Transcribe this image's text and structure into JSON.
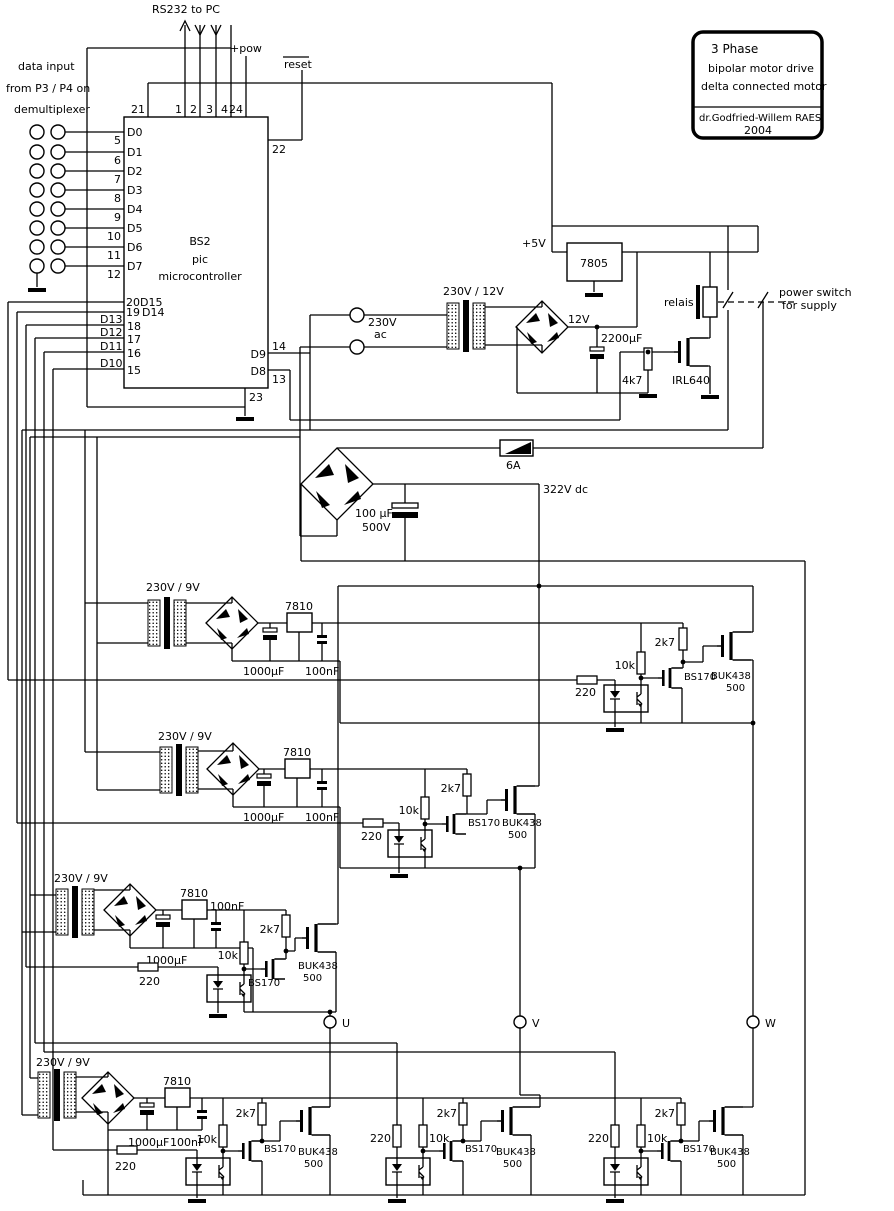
{
  "header": {
    "rs232": "RS232 to PC",
    "pow": "+pow",
    "reset": "reset"
  },
  "data_input": {
    "l1": "data input",
    "l2": "from P3 / P4 on",
    "l3": "demultiplexer"
  },
  "title_block": {
    "l1": "3 Phase",
    "l2": "bipolar  motor drive",
    "l3": "delta connected motor",
    "author": "dr.Godfried-Willem RAES",
    "year": "2004"
  },
  "mcu": {
    "l1": "BS2",
    "l2": "pic",
    "l3": "microcontroller",
    "top_pins": [
      "21",
      "1",
      "2",
      "3",
      "4",
      "24"
    ],
    "pin22": "22",
    "pin23": "23",
    "data_pins": [
      {
        "pin": "5",
        "name": "D0"
      },
      {
        "pin": "6",
        "name": "D1"
      },
      {
        "pin": "7",
        "name": "D2"
      },
      {
        "pin": "8",
        "name": "D3"
      },
      {
        "pin": "9",
        "name": "D4"
      },
      {
        "pin": "10",
        "name": "D5"
      },
      {
        "pin": "11",
        "name": "D6"
      },
      {
        "pin": "12",
        "name": "D7"
      }
    ],
    "bus_pins": [
      {
        "pin": "20",
        "name": "D15"
      },
      {
        "pin": "19",
        "name": "D14"
      },
      {
        "pin": "18",
        "name": "D13"
      },
      {
        "pin": "17",
        "name": "D12"
      },
      {
        "pin": "16",
        "name": "D11"
      },
      {
        "pin": "15",
        "name": "D10"
      }
    ],
    "right_pins": [
      {
        "pin": "14",
        "name": "D9"
      },
      {
        "pin": "13",
        "name": "D8"
      }
    ]
  },
  "psu": {
    "v5": "+5V",
    "reg": "7805",
    "xfmr": "230V / 12V",
    "mains_v": "230V",
    "mains_ac": "ac",
    "v12": "12V",
    "cap": "2200µF",
    "relay": "relais",
    "switch_l1": "power switch",
    "switch_l2": "for supply",
    "r_gate": "4k7",
    "fet": "IRL640"
  },
  "dc_bus": {
    "fuse": "6A",
    "volts": "322V dc",
    "cap_v": "100 µF",
    "cap_r": "500V"
  },
  "parts": {
    "xfmr": "230V / 9V",
    "reg": "7810",
    "cap_el": "1000µF",
    "cap_f": "100nF",
    "r220": "220",
    "r10k": "10k",
    "r2k7": "2k7",
    "fet1": "BS170",
    "fet2": "BUK438",
    "fet2b": "500"
  },
  "outputs": {
    "u": "U",
    "v": "V",
    "w": "W"
  }
}
